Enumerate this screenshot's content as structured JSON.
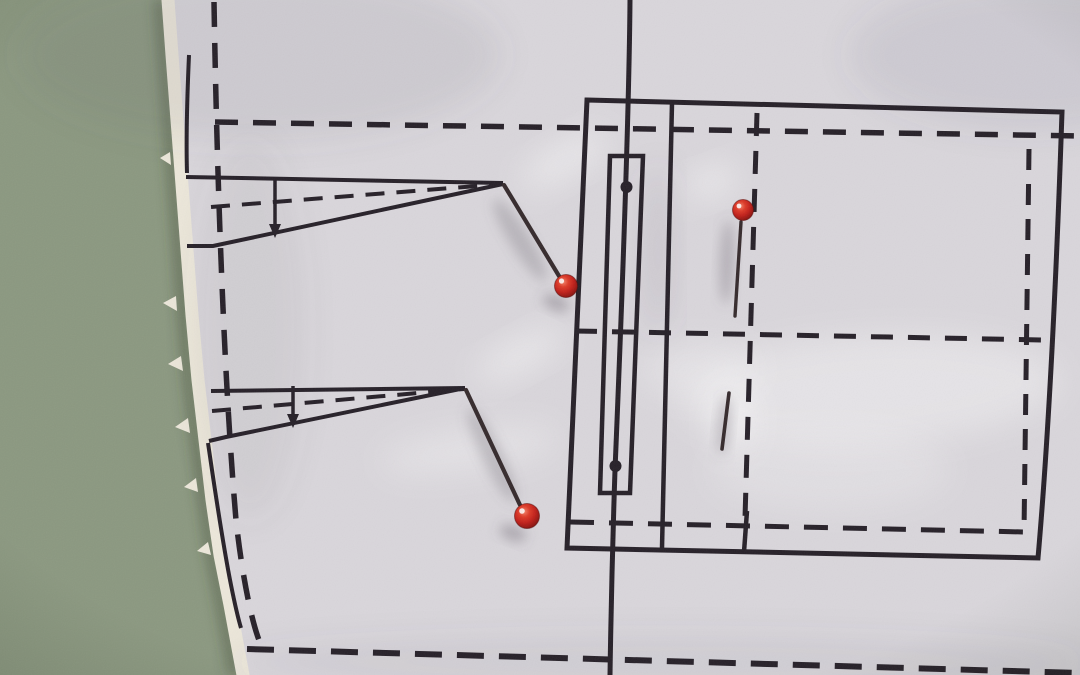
{
  "meta": {
    "description": "Photograph: white sewing-pattern paper with dart and pocket markings, pinned with three red glass-head pins, lying on a sage-green surface; torn paper edge on the left."
  },
  "scene": {
    "colors": {
      "background": "#8b9880",
      "paper": "#d9d6db",
      "deckle": "#ece7da",
      "line": "#262028",
      "pinShaft": "#352a2c",
      "pinRed": "#c2231b"
    },
    "elements": [
      {
        "tag": "rect",
        "name": "green-table-surface",
        "attrs": {
          "x": 0,
          "y": 0,
          "width": 1080,
          "height": 675,
          "fill": "$background"
        }
      },
      {
        "tag": "path",
        "name": "paper-edge-shadow",
        "attrs": {
          "d": "M159,0 L163,55 168,120 173,185 178,250 183,315 189,380 196,440 203,500 211,555 221,605 234,675",
          "fill": "none",
          "stroke": "rgba(60,70,52,0.5)",
          "stroke-width": "9",
          "filter": "url(#f-soft)"
        }
      },
      {
        "tag": "path",
        "name": "pattern-paper",
        "attrs": {
          "d": "M168,0 L172,55 177,120 182,185 187,250 192,315 198,380 205,440 212,500 220,555 230,605 243,675 L1080,675 L1080,0 Z",
          "fill": "$paper"
        }
      },
      {
        "tag": "path",
        "name": "torn-deckle-edge",
        "attrs": {
          "d": "M168,0 L172,55 177,120 182,185 187,250 192,315 198,380 205,440 212,500 220,555 230,605 243,675",
          "fill": "none",
          "stroke": "$deckle",
          "stroke-width": "13",
          "stroke-linecap": "round",
          "stroke-linejoin": "round"
        }
      },
      {
        "tag": "path",
        "name": "deckle-fiber-1",
        "attrs": {
          "d": "M170,152 L160,158 L171,165 Z",
          "fill": "$deckle"
        }
      },
      {
        "tag": "path",
        "name": "deckle-fiber-2",
        "attrs": {
          "d": "M176,296 L163,303 L177,311 Z",
          "fill": "$deckle"
        }
      },
      {
        "tag": "path",
        "name": "deckle-fiber-3",
        "attrs": {
          "d": "M181,356 L168,364 L183,371 Z",
          "fill": "$deckle"
        }
      },
      {
        "tag": "path",
        "name": "deckle-fiber-4",
        "attrs": {
          "d": "M188,418 L175,427 L190,433 Z",
          "fill": "$deckle"
        }
      },
      {
        "tag": "path",
        "name": "deckle-fiber-5",
        "attrs": {
          "d": "M196,478 L184,487 L198,492 Z",
          "fill": "$deckle"
        }
      },
      {
        "tag": "path",
        "name": "deckle-fiber-6",
        "attrs": {
          "d": "M208,542 L197,551 L211,555 Z",
          "fill": "$deckle"
        }
      },
      {
        "tag": "ellipse",
        "name": "paper-shade-top-left",
        "attrs": {
          "cx": 260,
          "cy": 55,
          "rx": 240,
          "ry": 85,
          "fill": "rgba(92,86,106,0.10)",
          "filter": "url(#f-softer)"
        }
      },
      {
        "tag": "ellipse",
        "name": "paper-shade-top-right",
        "attrs": {
          "cx": 1030,
          "cy": 55,
          "rx": 180,
          "ry": 75,
          "fill": "rgba(92,86,106,0.09)",
          "filter": "url(#f-softer)"
        }
      },
      {
        "tag": "ellipse",
        "name": "paper-shade-left-strip",
        "attrs": {
          "cx": 250,
          "cy": 330,
          "rx": 55,
          "ry": 190,
          "fill": "rgba(92,86,106,0.07)",
          "filter": "url(#f-softer)"
        }
      },
      {
        "tag": "ellipse",
        "name": "paper-shade-pocket-band",
        "attrs": {
          "cx": 658,
          "cy": 250,
          "rx": 13,
          "ry": 85,
          "fill": "rgba(100,94,112,0.15)",
          "filter": "url(#f-softer)"
        }
      },
      {
        "tag": "ellipse",
        "name": "paper-shade-bottom-strip",
        "attrs": {
          "cx": 660,
          "cy": 662,
          "rx": 430,
          "ry": 26,
          "fill": "rgba(92,86,106,0.08)",
          "filter": "url(#f-softer)"
        }
      },
      {
        "tag": "ellipse",
        "name": "crease-highlight-right-band",
        "attrs": {
          "cx": 870,
          "cy": 390,
          "rx": 190,
          "ry": 55,
          "fill": "rgba(255,255,255,0.32)",
          "filter": "url(#f-softer)",
          "transform": "rotate(-3 870 390)"
        }
      },
      {
        "tag": "ellipse",
        "name": "crease-highlight-mid",
        "attrs": {
          "cx": 700,
          "cy": 370,
          "rx": 60,
          "ry": 28,
          "fill": "rgba(255,255,255,0.25)",
          "filter": "url(#f-softer)"
        }
      },
      {
        "tag": "ellipse",
        "name": "crease-highlight-bottom-mid",
        "attrs": {
          "cx": 830,
          "cy": 470,
          "rx": 120,
          "ry": 40,
          "fill": "rgba(255,255,255,0.20)",
          "filter": "url(#f-softer)"
        }
      },
      {
        "tag": "ellipse",
        "name": "crease-highlight-dart1-apex",
        "attrs": {
          "cx": 565,
          "cy": 160,
          "rx": 50,
          "ry": 16,
          "fill": "rgba(255,255,255,0.45)",
          "filter": "url(#f-softer)",
          "transform": "rotate(-30 565 160)"
        }
      },
      {
        "tag": "ellipse",
        "name": "crease-highlight-dart2-apex",
        "attrs": {
          "cx": 520,
          "cy": 355,
          "rx": 48,
          "ry": 15,
          "fill": "rgba(255,255,255,0.45)",
          "filter": "url(#f-softer)",
          "transform": "rotate(-28 520 355)"
        }
      },
      {
        "tag": "ellipse",
        "name": "crease-highlight-dart2-low",
        "attrs": {
          "cx": 470,
          "cy": 450,
          "rx": 90,
          "ry": 20,
          "fill": "rgba(255,255,255,0.30)",
          "filter": "url(#f-softer)",
          "transform": "rotate(-8 470 450)"
        }
      },
      {
        "tag": "ellipse",
        "name": "crease-highlight-pin3-head",
        "attrs": {
          "cx": 712,
          "cy": 182,
          "rx": 26,
          "ry": 14,
          "fill": "rgba(255,255,255,0.50)",
          "filter": "url(#f-softer)",
          "transform": "rotate(-20 712 182)"
        }
      },
      {
        "tag": "ellipse",
        "name": "crease-highlight-pin3-tip",
        "attrs": {
          "cx": 733,
          "cy": 420,
          "rx": 20,
          "ry": 34,
          "fill": "rgba(255,255,255,0.45)",
          "filter": "url(#f-softer)"
        }
      },
      {
        "tag": "path",
        "name": "seam-dashed-top",
        "attrs": {
          "d": "M215,122 L1080,136",
          "fill": "none",
          "stroke": "$line",
          "stroke-width": "5.5",
          "stroke-dasharray": "23 15"
        }
      },
      {
        "tag": "path",
        "name": "seam-dashed-left",
        "attrs": {
          "d": "M214,2 C217,180 224,380 236,520 C242,575 252,625 261,645",
          "fill": "none",
          "stroke": "$line",
          "stroke-width": "5.5",
          "stroke-dasharray": "25 16"
        }
      },
      {
        "tag": "path",
        "name": "seam-dashed-bottom",
        "attrs": {
          "d": "M247,649 L1080,673",
          "fill": "none",
          "stroke": "$line",
          "stroke-width": "6",
          "stroke-dasharray": "27 15"
        }
      },
      {
        "tag": "path",
        "name": "center-front-line",
        "attrs": {
          "d": "M630,0 C629,120 620,350 615,470 C612,560 611,610 610,675",
          "fill": "none",
          "stroke": "$line",
          "stroke-width": "5"
        }
      },
      {
        "tag": "path",
        "name": "pocket-outline-rect",
        "attrs": {
          "d": "M587,100 L1062,112 C1057,260 1050,420 1038,558 L567,548 Z",
          "fill": "none",
          "stroke": "$line",
          "stroke-width": "5"
        }
      },
      {
        "tag": "path",
        "name": "pocket-divider-line",
        "attrs": {
          "d": "M672,103 L662,548",
          "fill": "none",
          "stroke": "$line",
          "stroke-width": "4.5"
        }
      },
      {
        "tag": "path",
        "name": "welt-pocket-rect",
        "attrs": {
          "d": "M610,156 L643,156 L630,493 L600,493 Z",
          "fill": "none",
          "stroke": "$line",
          "stroke-width": "4.5"
        }
      },
      {
        "tag": "circle",
        "name": "welt-drill-dot-top",
        "attrs": {
          "cx": 626.5,
          "cy": 187,
          "r": 6,
          "fill": "$line"
        }
      },
      {
        "tag": "circle",
        "name": "welt-drill-dot-bottom",
        "attrs": {
          "cx": 615.5,
          "cy": 466,
          "r": 6,
          "fill": "$line"
        }
      },
      {
        "tag": "path",
        "name": "pocket-dashed-vertical-mid",
        "attrs": {
          "d": "M757,113 L745,518",
          "fill": "none",
          "stroke": "$line",
          "stroke-width": "5",
          "stroke-dasharray": "23 15"
        }
      },
      {
        "tag": "path",
        "name": "pocket-tick-mark",
        "attrs": {
          "d": "M747,511 L744,552",
          "fill": "none",
          "stroke": "$line",
          "stroke-width": "4.5"
        }
      },
      {
        "tag": "path",
        "name": "pocket-dashed-horizontal-mid",
        "attrs": {
          "d": "M575,331 L1043,340",
          "fill": "none",
          "stroke": "$line",
          "stroke-width": "5",
          "stroke-dasharray": "22 15"
        }
      },
      {
        "tag": "path",
        "name": "pocket-dashed-vertical-right",
        "attrs": {
          "d": "M1029,149 L1024,532",
          "fill": "none",
          "stroke": "$line",
          "stroke-width": "5",
          "stroke-dasharray": "21 14"
        }
      },
      {
        "tag": "path",
        "name": "pocket-dashed-horizontal-bottom",
        "attrs": {
          "d": "M570,522 L1025,532",
          "fill": "none",
          "stroke": "$line",
          "stroke-width": "5",
          "stroke-dasharray": "24 15"
        }
      },
      {
        "tag": "path",
        "name": "dart1-top-leg",
        "attrs": {
          "d": "M186,177 L503,183",
          "fill": "none",
          "stroke": "$line",
          "stroke-width": "4"
        }
      },
      {
        "tag": "path",
        "name": "dart1-bottom-leg",
        "attrs": {
          "d": "M503,184 L213,246 L187,246",
          "fill": "none",
          "stroke": "$line",
          "stroke-width": "4"
        }
      },
      {
        "tag": "path",
        "name": "dart1-center-dashed",
        "attrs": {
          "d": "M211,207 L502,184",
          "fill": "none",
          "stroke": "$line",
          "stroke-width": "4",
          "stroke-dasharray": "19 12"
        }
      },
      {
        "tag": "path",
        "name": "dart1-fold-tick",
        "attrs": {
          "d": "M275,178 L275,226",
          "fill": "none",
          "stroke": "$line",
          "stroke-width": "3.5"
        }
      },
      {
        "tag": "polygon",
        "name": "dart1-fold-arrowhead",
        "attrs": {
          "points": "269,224 281,224 275,238",
          "fill": "$line"
        }
      },
      {
        "tag": "path",
        "name": "dart2-top-leg",
        "attrs": {
          "d": "M211,391 L465,388",
          "fill": "none",
          "stroke": "$line",
          "stroke-width": "4"
        }
      },
      {
        "tag": "path",
        "name": "dart2-bottom-leg",
        "attrs": {
          "d": "M465,388 L226,437 L209,441",
          "fill": "none",
          "stroke": "$line",
          "stroke-width": "4"
        }
      },
      {
        "tag": "path",
        "name": "dart2-center-dashed",
        "attrs": {
          "d": "M212,411 L464,389",
          "fill": "none",
          "stroke": "$line",
          "stroke-width": "4",
          "stroke-dasharray": "19 12"
        }
      },
      {
        "tag": "path",
        "name": "dart2-fold-tick",
        "attrs": {
          "d": "M293,386 L293,416",
          "fill": "none",
          "stroke": "$line",
          "stroke-width": "3.5"
        }
      },
      {
        "tag": "polygon",
        "name": "dart2-fold-arrowhead",
        "attrs": {
          "points": "287,414 299,414 293,428",
          "fill": "$line"
        }
      },
      {
        "tag": "path",
        "name": "cut-edge-line-upper",
        "attrs": {
          "d": "M189,55 C187,100 186,140 187,173",
          "fill": "none",
          "stroke": "$line",
          "stroke-width": "4"
        }
      },
      {
        "tag": "path",
        "name": "cut-edge-line-lower",
        "attrs": {
          "d": "M208,443 C215,490 222,540 231,585 C235,605 238,618 241,628",
          "fill": "none",
          "stroke": "$line",
          "stroke-width": "4"
        }
      },
      {
        "tag": "ellipse",
        "name": "pin1-shaft-shadow",
        "attrs": {
          "cx": 520,
          "cy": 240,
          "rx": 10,
          "ry": 48,
          "fill": "rgba(105,98,110,0.30)",
          "filter": "url(#f-soft)",
          "transform": "rotate(-32 520 240)"
        }
      },
      {
        "tag": "ellipse",
        "name": "pin1-head-shadow",
        "attrs": {
          "cx": 556,
          "cy": 303,
          "rx": 14,
          "ry": 7,
          "fill": "rgba(95,88,100,0.40)",
          "filter": "url(#f-soft)",
          "transform": "rotate(25 556 303)"
        }
      },
      {
        "tag": "ellipse",
        "name": "pin2-shaft-shadow",
        "attrs": {
          "cx": 492,
          "cy": 455,
          "rx": 10,
          "ry": 52,
          "fill": "rgba(105,98,110,0.30)",
          "filter": "url(#f-soft)",
          "transform": "rotate(-26 492 455)"
        }
      },
      {
        "tag": "ellipse",
        "name": "pin2-head-shadow",
        "attrs": {
          "cx": 513,
          "cy": 533,
          "rx": 14,
          "ry": 7,
          "fill": "rgba(95,88,100,0.40)",
          "filter": "url(#f-soft)",
          "transform": "rotate(20 513 533)"
        }
      },
      {
        "tag": "ellipse",
        "name": "pin3-shaft-shadow",
        "attrs": {
          "cx": 727,
          "cy": 262,
          "rx": 7,
          "ry": 42,
          "fill": "rgba(105,98,110,0.35)",
          "filter": "url(#f-soft)",
          "transform": "rotate(2 727 262)"
        }
      },
      {
        "tag": "ellipse",
        "name": "pin3-tip-shadow",
        "attrs": {
          "cx": 724,
          "cy": 425,
          "rx": 6,
          "ry": 30,
          "fill": "rgba(105,98,110,0.35)",
          "filter": "url(#f-soft)",
          "transform": "rotate(5 724 425)"
        }
      },
      {
        "tag": "path",
        "name": "pin3-shaft",
        "attrs": {
          "d": "M741,222 L735,316",
          "fill": "none",
          "stroke": "$pinShaft",
          "stroke-width": "3.4",
          "stroke-linecap": "round"
        }
      },
      {
        "tag": "path",
        "name": "pin3-tip",
        "attrs": {
          "d": "M729,393 L722,449",
          "fill": "none",
          "stroke": "$pinShaft",
          "stroke-width": "3.6",
          "stroke-linecap": "round"
        }
      },
      {
        "tag": "path",
        "name": "pin1-shaft",
        "attrs": {
          "d": "M504,185 L559,276",
          "fill": "none",
          "stroke": "$pinShaft",
          "stroke-width": "4.2",
          "stroke-linecap": "round"
        }
      },
      {
        "tag": "path",
        "name": "pin2-shaft",
        "attrs": {
          "d": "M466,390 L520,505",
          "fill": "none",
          "stroke": "$pinShaft",
          "stroke-width": "4.2",
          "stroke-linecap": "round"
        }
      },
      {
        "tag": "circle",
        "name": "pin1-head",
        "attrs": {
          "cx": 566,
          "cy": 286,
          "r": 11.5,
          "fill": "url(#g-pinhead)",
          "stroke": "rgba(80,8,6,0.5)",
          "stroke-width": "1"
        }
      },
      {
        "tag": "circle",
        "name": "pin2-head",
        "attrs": {
          "cx": 527,
          "cy": 516,
          "r": 12.5,
          "fill": "url(#g-pinhead)",
          "stroke": "rgba(80,8,6,0.5)",
          "stroke-width": "1"
        }
      },
      {
        "tag": "circle",
        "name": "pin3-head",
        "attrs": {
          "cx": 743,
          "cy": 210,
          "r": 10.5,
          "fill": "url(#g-pinhead)",
          "stroke": "rgba(80,8,6,0.5)",
          "stroke-width": "1"
        }
      },
      {
        "tag": "circle",
        "name": "pin1-head-specular",
        "attrs": {
          "cx": 561.5,
          "cy": 281,
          "r": 2.6,
          "fill": "rgba(255,255,255,0.85)"
        }
      },
      {
        "tag": "circle",
        "name": "pin2-head-specular",
        "attrs": {
          "cx": 522,
          "cy": 511,
          "r": 2.8,
          "fill": "rgba(255,255,255,0.85)"
        }
      },
      {
        "tag": "circle",
        "name": "pin3-head-specular",
        "attrs": {
          "cx": 739,
          "cy": 206,
          "r": 2.4,
          "fill": "rgba(255,255,255,0.85)"
        }
      },
      {
        "tag": "rect",
        "name": "photo-vignette",
        "attrs": {
          "x": 0,
          "y": 0,
          "width": 1080,
          "height": 675,
          "fill": "url(#g-vig)"
        }
      },
      {
        "tag": "rect",
        "name": "photo-grain",
        "attrs": {
          "x": 0,
          "y": 0,
          "width": 1080,
          "height": 675,
          "filter": "url(#f-grain)",
          "opacity": "0.07"
        }
      }
    ]
  }
}
